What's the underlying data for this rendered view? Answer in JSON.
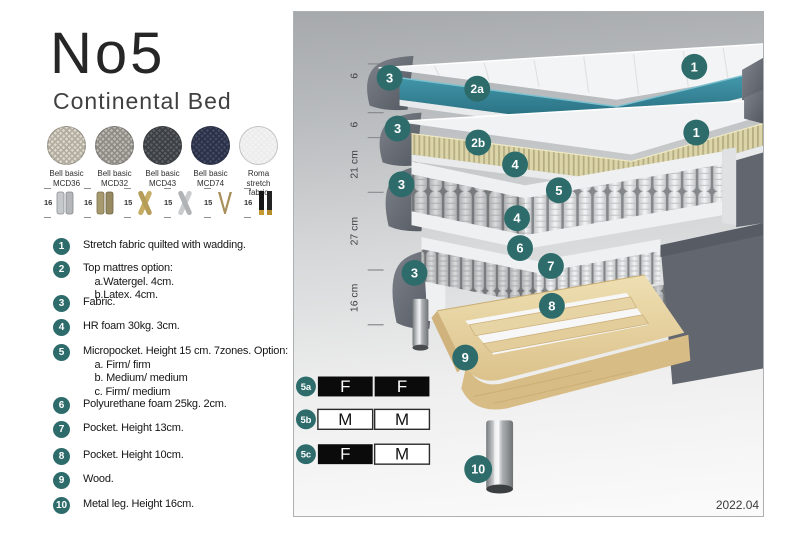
{
  "header": {
    "title": "No5",
    "subtitle": "Continental Bed"
  },
  "fabric_swatches": [
    {
      "label": "Bell basic\nMCD36",
      "base_color": "#dbd6cb",
      "weave_color": "#b2ac9f"
    },
    {
      "label": "Bell basic\nMCD32",
      "base_color": "#bab8b3",
      "weave_color": "#8e8b85"
    },
    {
      "label": "Bell basic\nMCD43",
      "base_color": "#5b5f63",
      "weave_color": "#3b3f43"
    },
    {
      "label": "Bell basic\nMCD74",
      "base_color": "#424961",
      "weave_color": "#293048"
    },
    {
      "label": "Roma\nstretch fabric",
      "base_color": "#f3f3f3",
      "weave_color": "#ececec"
    }
  ],
  "leg_options": [
    {
      "height": "16",
      "type": "cylinder-silver"
    },
    {
      "height": "16",
      "type": "cylinder-bronze"
    },
    {
      "height": "15",
      "type": "cross-gold"
    },
    {
      "height": "15",
      "type": "cross-silver"
    },
    {
      "height": "15",
      "type": "hairpin-metal"
    },
    {
      "height": "16",
      "type": "black-gold"
    }
  ],
  "legend": [
    {
      "number": "1",
      "text": "Stretch fabric quilted with wadding."
    },
    {
      "number": "2",
      "text": "Top mattres option:\n    a.Watergel. 4cm.\n    b.Latex. 4cm."
    },
    {
      "number": "3",
      "text": "Fabric."
    },
    {
      "number": "4",
      "text": "HR foam 30kg. 3cm."
    },
    {
      "number": "5",
      "text": "Micropocket. Height 15 cm. 7zones. Option:\n    a. Firm/ firm\n    b. Medium/ medium\n    c. Firm/ medium"
    },
    {
      "number": "6",
      "text": "Polyurethane foam 25kg. 2cm."
    },
    {
      "number": "7",
      "text": "Pocket. Height 13cm."
    },
    {
      "number": "8",
      "text": "Pocket. Height 10cm."
    },
    {
      "number": "9",
      "text": "Wood."
    },
    {
      "number": "10",
      "text": "Metal leg. Height 16cm."
    }
  ],
  "diagram": {
    "dimensions": [
      {
        "label": "6"
      },
      {
        "label": "6"
      },
      {
        "label": "21 cm"
      },
      {
        "label": "27 cm"
      },
      {
        "label": "16 cm"
      }
    ],
    "callouts": [
      {
        "label": "3"
      },
      {
        "label": "1"
      },
      {
        "label": "2a"
      },
      {
        "label": "3"
      },
      {
        "label": "2b"
      },
      {
        "label": "1"
      },
      {
        "label": "4"
      },
      {
        "label": "5"
      },
      {
        "label": "3"
      },
      {
        "label": "4"
      },
      {
        "label": "6"
      },
      {
        "label": "7"
      },
      {
        "label": "3"
      },
      {
        "label": "8"
      },
      {
        "label": "9"
      },
      {
        "label": "10"
      }
    ],
    "firmness_table": {
      "rows": [
        {
          "id": "5a",
          "cells": [
            {
              "text": "F",
              "variant": "dark"
            },
            {
              "text": "F",
              "variant": "dark"
            }
          ]
        },
        {
          "id": "5b",
          "cells": [
            {
              "text": "M",
              "variant": "light"
            },
            {
              "text": "M",
              "variant": "light"
            }
          ]
        },
        {
          "id": "5c",
          "cells": [
            {
              "text": "F",
              "variant": "dark"
            },
            {
              "text": "M",
              "variant": "light"
            }
          ]
        }
      ]
    },
    "version": "2022.04"
  },
  "colors": {
    "callout_teal": "#2e6c6c",
    "watergel_teal": "#2f839a",
    "latex_beige": "#d9d2a6",
    "fabric_gray": "#6a6f78",
    "wood": "#e3cf9f",
    "table_dark": "#0b0b0b"
  }
}
